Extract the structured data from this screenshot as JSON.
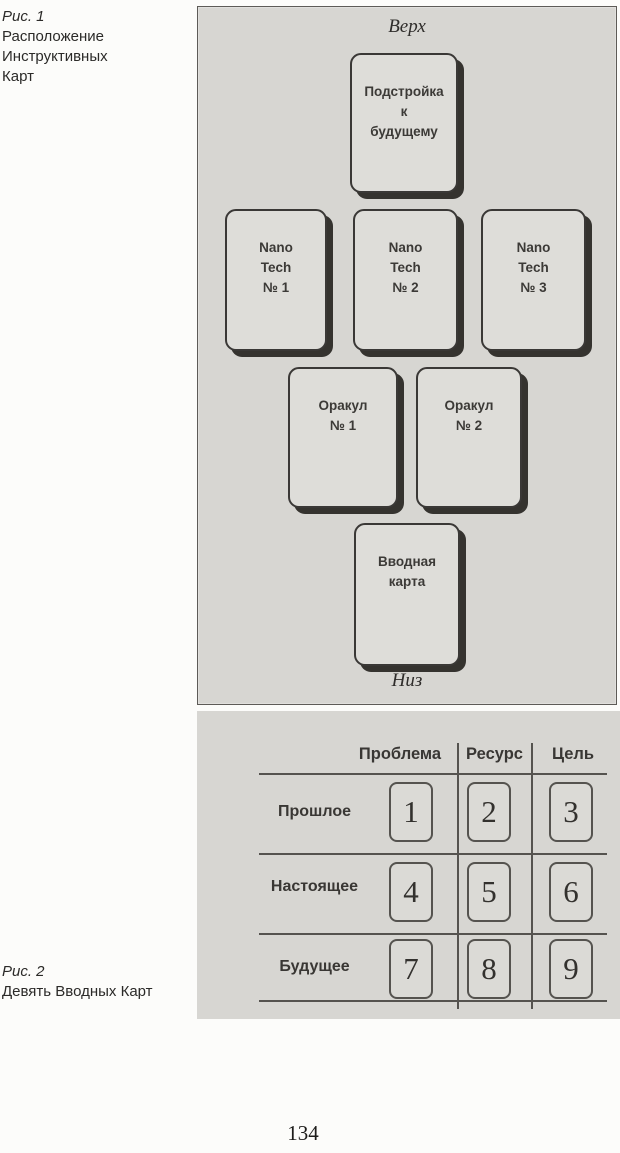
{
  "figure1": {
    "caption": {
      "label": "Рис. 1",
      "text": "Расположение Инструктивных Карт",
      "lines": "Расположение\nИнструктивных\nКарт"
    },
    "top_label": "Верх",
    "bottom_label": "Низ",
    "cards": [
      {
        "id": "tuning",
        "text": "Подстройка\nк\nбудущему"
      },
      {
        "id": "nano-1",
        "text": "Nano\nTech\n№ 1"
      },
      {
        "id": "nano-2",
        "text": "Nano\nTech\n№ 2"
      },
      {
        "id": "nano-3",
        "text": "Nano\nTech\n№ 3"
      },
      {
        "id": "oracle-1",
        "text": "Оракул\n№ 1"
      },
      {
        "id": "oracle-2",
        "text": "Оракул\n№ 2"
      },
      {
        "id": "intro",
        "text": "Вводная\nкарта"
      }
    ]
  },
  "figure2": {
    "caption": {
      "label": "Рис. 2",
      "text": "Девять Вводных Карт"
    },
    "columns": [
      "Проблема",
      "Ресурс",
      "Цель"
    ],
    "rows": [
      "Прошлое",
      "Настоящее",
      "Будущее"
    ],
    "cells": [
      [
        "1",
        "2",
        "3"
      ],
      [
        "4",
        "5",
        "6"
      ],
      [
        "7",
        "8",
        "9"
      ]
    ]
  },
  "page": {
    "number": "134"
  },
  "colors": {
    "panel_background": "#d7d6d2",
    "card_background": "#deddd9",
    "card_border": "#3a3836",
    "card_shadow": "#35332f",
    "line": "#55534f",
    "text": "#393734"
  }
}
